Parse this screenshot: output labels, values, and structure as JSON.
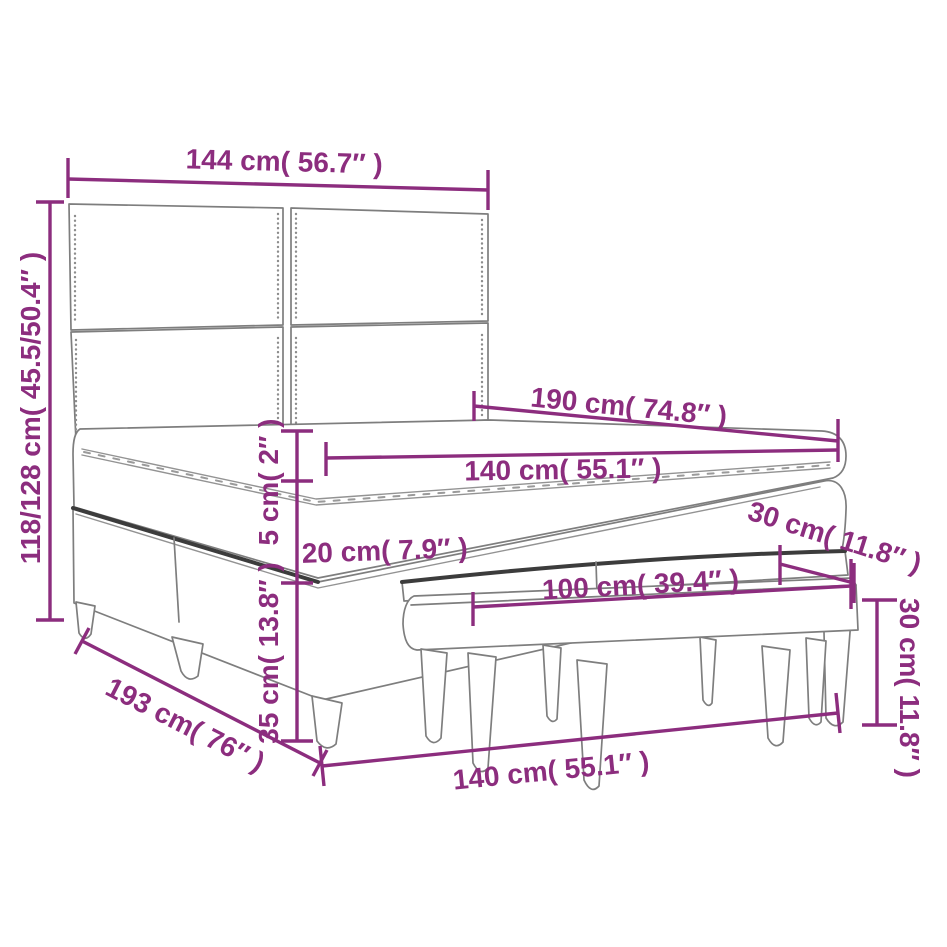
{
  "colors": {
    "dimension": "#8C2D7E",
    "furniture": "#7E7E7E",
    "furniture_dark": "#3C3C3C",
    "background": "#FFFFFF"
  },
  "dims": {
    "headboard_width": "144 cm( 56.7″ )",
    "bed_height_range": "118/128 cm( 45.5/50.4″ )",
    "bed_length": "190 cm( 74.8″ )",
    "mattress_width": "140 cm( 55.1″ )",
    "topper_thickness": "5 cm( 2″ )",
    "mattress_thickness": "20 cm( 7.9″ )",
    "base_height": "35 cm( 13.8″ )",
    "bench_length": "100 cm( 39.4″ )",
    "bench_depth": "30 cm( 11.8″ )",
    "bench_height": "30 cm( 11.8″ )",
    "frame_width": "140 cm( 55.1″ )",
    "frame_length": "193 cm( 76″ )"
  }
}
